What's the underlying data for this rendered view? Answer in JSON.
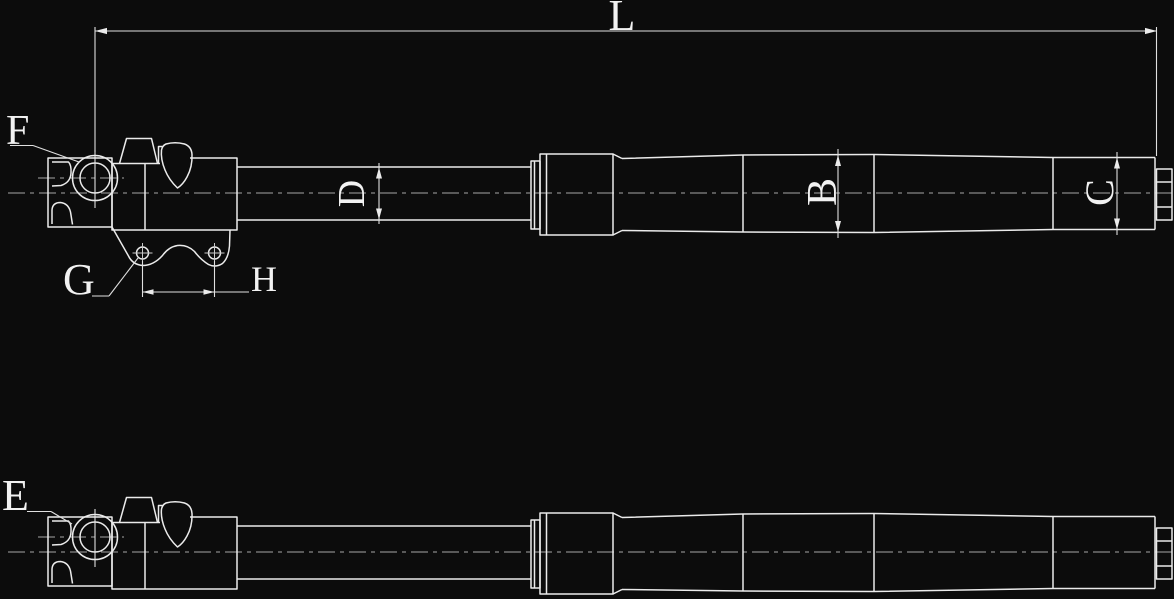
{
  "drawing": {
    "background_color": "#0c0c0c",
    "line_color": "#ebebeb",
    "centerline_color": "#a6a6a6",
    "text_color": "#f2f2f2",
    "labels": {
      "overall_length": "L",
      "inner_tube_diameter": "D",
      "outer_tube_diameter": "B",
      "end_section_diameter": "C",
      "axle_hole_callout": "F",
      "bracket_hole_callout": "G",
      "bracket_hole_spacing": "H",
      "second_view_callout": "E"
    }
  }
}
